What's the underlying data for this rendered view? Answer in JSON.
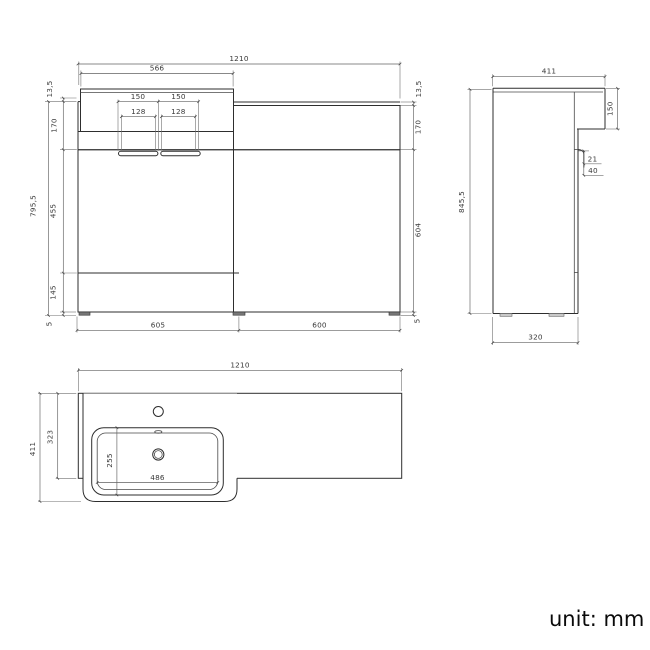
{
  "note": {
    "unit": "unit: mm"
  },
  "front": {
    "w_total": "1210",
    "w_counter": "566",
    "t_top_l": "13,5",
    "h_apron_l": "170",
    "h_total": "795,5",
    "h_door": "455",
    "h_drawer": "145",
    "h_foot_l": "5",
    "w_handle_1": "150",
    "w_handle_2": "150",
    "w_handle_inner_1": "128",
    "w_handle_inner_2": "128",
    "w_left_unit": "605",
    "w_right_unit": "600",
    "t_top_r": "13,5",
    "h_apron_r": "170",
    "h_door_r": "604",
    "h_foot_r": "5"
  },
  "side": {
    "d_total": "411",
    "h_counter_drop": "150",
    "handle_offset": "21",
    "handle_depth": "40",
    "h_total": "845,5",
    "d_cabinet": "320"
  },
  "plan": {
    "w_total": "1210",
    "d_total": "411",
    "d_counter": "323",
    "d_basin": "255",
    "w_basin": "486"
  }
}
